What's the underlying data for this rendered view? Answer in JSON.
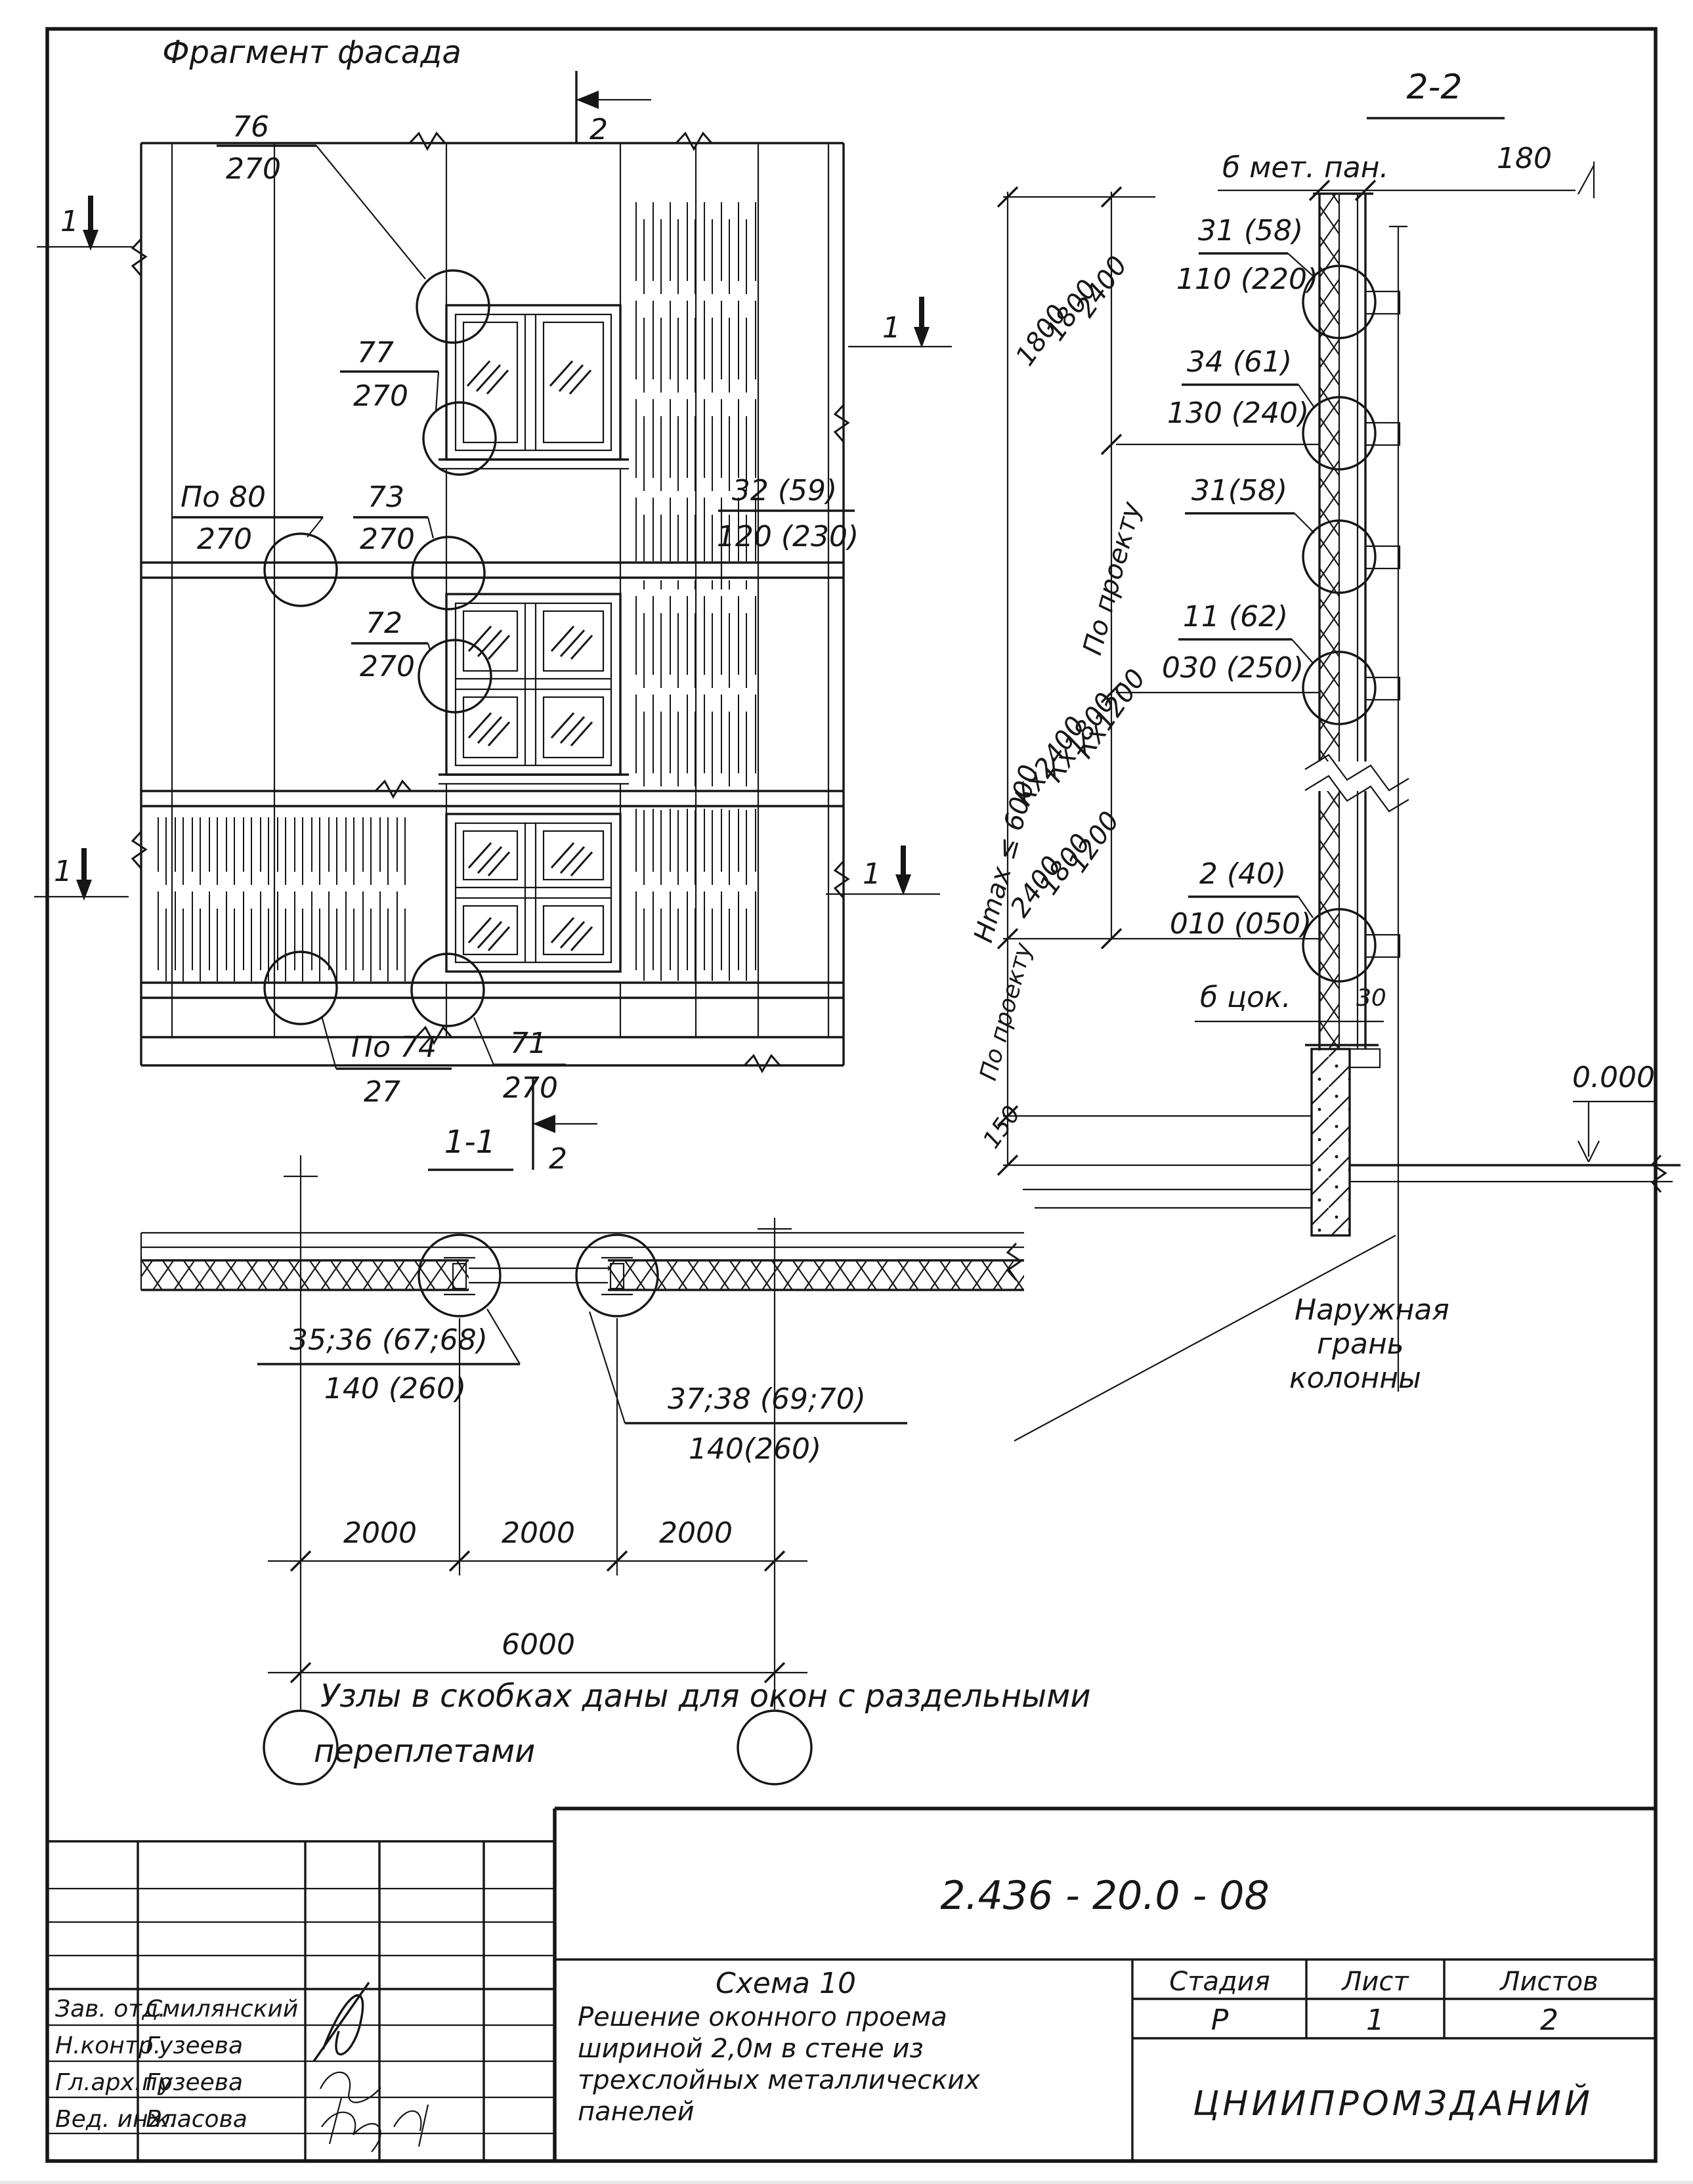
{
  "facade": {
    "title": "Фрагмент фасада",
    "marker_top": "2",
    "marker_bottom": "2",
    "marker_left_top": "1",
    "marker_left_bottom": "1",
    "marker_right_top": "1",
    "marker_right_bottom": "1",
    "callouts": {
      "k76": {
        "top": "76",
        "bot": "270"
      },
      "k77": {
        "top": "77",
        "bot": "270"
      },
      "k80": {
        "top": "По 80",
        "bot": "270"
      },
      "k73": {
        "top": "73",
        "bot": "270"
      },
      "k72": {
        "top": "72",
        "bot": "270"
      },
      "k32": {
        "top": "32 (59)",
        "bot": "120 (230)"
      },
      "k74": {
        "top": "По 74",
        "bot": "27"
      },
      "k71": {
        "top": "71",
        "bot": "270"
      }
    }
  },
  "plan": {
    "title": "1-1",
    "k3536": {
      "top": "35;36 (67;68)",
      "bot": "140 (260)"
    },
    "k3738": {
      "top": "37;38 (69;70)",
      "bot": "140(260)"
    },
    "dims": {
      "d1": "2000",
      "d2": "2000",
      "d3": "2000",
      "total": "6000"
    }
  },
  "section": {
    "title": "2-2",
    "panel_label": "б мет. пан.",
    "panel_width": "180",
    "k31a": {
      "top": "31 (58)",
      "bot": "110 (220)"
    },
    "k34": {
      "top": "34 (61)",
      "bot": "130 (240)"
    },
    "k31b": {
      "top": "31(58)"
    },
    "k11": {
      "top": "11 (62)",
      "bot": "030 (250)"
    },
    "k2": {
      "top": "2 (40)",
      "bot": "010 (050)"
    },
    "dims": {
      "h1": "1800",
      "h2": "1800",
      "h3": "2400",
      "po_proektu": "По проекту",
      "kx1": "Кх2400",
      "kx2": "Кх1800",
      "kx3": "Кх1200",
      "v1": "2400",
      "v2": "1800",
      "v3": "1200",
      "hmax": "Hmax ≤ 6000",
      "po_proektu2": "По проекту",
      "off150": "150"
    },
    "plinth_label": "б цок.",
    "plinth_offset": "30",
    "zero_level": "0.000",
    "column_note1": "Наружная",
    "column_note2": "грань",
    "column_note3": "колонны"
  },
  "note": {
    "line1": "Узлы  в  скобках  даны  для  окон  с  раздельными",
    "line2": "переплетами"
  },
  "title_block": {
    "doc_number": "2.436 - 20.0 - 08",
    "scheme_title": "Схема 10",
    "desc1": "Решение  оконного  проема",
    "desc2": "шириной  2,0м  в  стене  из",
    "desc3": "трехслойных  металлических",
    "desc4": "панелей",
    "stage_label": "Стадия",
    "sheet_label": "Лист",
    "sheets_label": "Листов",
    "stage": "Р",
    "sheet": "1",
    "sheets": "2",
    "org": "ЦНИИПРОМЗДАНИЙ",
    "roles": [
      {
        "role": "Зав. отд.",
        "name": "Смилянский"
      },
      {
        "role": "Н.контр.",
        "name": "Гузеева"
      },
      {
        "role": "Гл.арх.пр",
        "name": "Гузеева"
      },
      {
        "role": "Вед. инж.",
        "name": "Власова"
      }
    ]
  }
}
